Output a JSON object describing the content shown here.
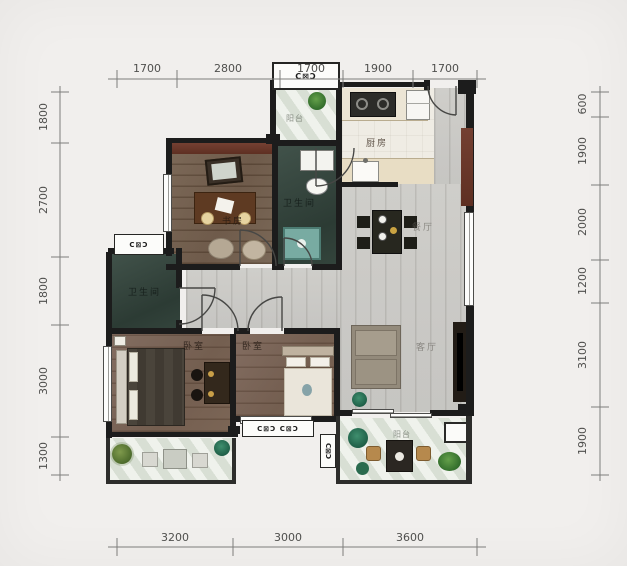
{
  "title": "三室两厅户型图",
  "dimensions": {
    "top": [
      "1700",
      "2800",
      "1700",
      "1900",
      "1700"
    ],
    "left": [
      "1800",
      "2700",
      "1800",
      "3000",
      "1300"
    ],
    "right": [
      "600",
      "1900",
      "2000",
      "1200",
      "3100",
      "1900"
    ],
    "bottom": [
      "3200",
      "3000",
      "3600"
    ]
  },
  "rooms": {
    "study": {
      "label": "书房"
    },
    "bathroom_main": {
      "label": "卫生间"
    },
    "bathroom_second": {
      "label": "卫生间"
    },
    "kitchen": {
      "label": "厨房"
    },
    "dining": {
      "label": "餐厅"
    },
    "living": {
      "label": "客厅"
    },
    "bedroom_left": {
      "label": "卧室"
    },
    "bedroom_middle": {
      "label": "卧室"
    },
    "balcony_service": {
      "label": "阳台"
    },
    "balcony_main": {
      "label": "阳台"
    }
  },
  "window_tags": {
    "top": "C⊠Ɔ",
    "left": "C⊠Ɔ",
    "bottom": "C⊠Ɔ C⊠Ɔ",
    "side": "C⊠Ɔ"
  },
  "colors": {
    "wall": "#1c1c1c",
    "feature_wall": "#6b382a",
    "wood_brown": "#74604e",
    "wood_gray": "#c8c7c3",
    "bath_teal": "#32423b",
    "balcony_pale": "#e2e7dd",
    "background": "#f1efed"
  }
}
